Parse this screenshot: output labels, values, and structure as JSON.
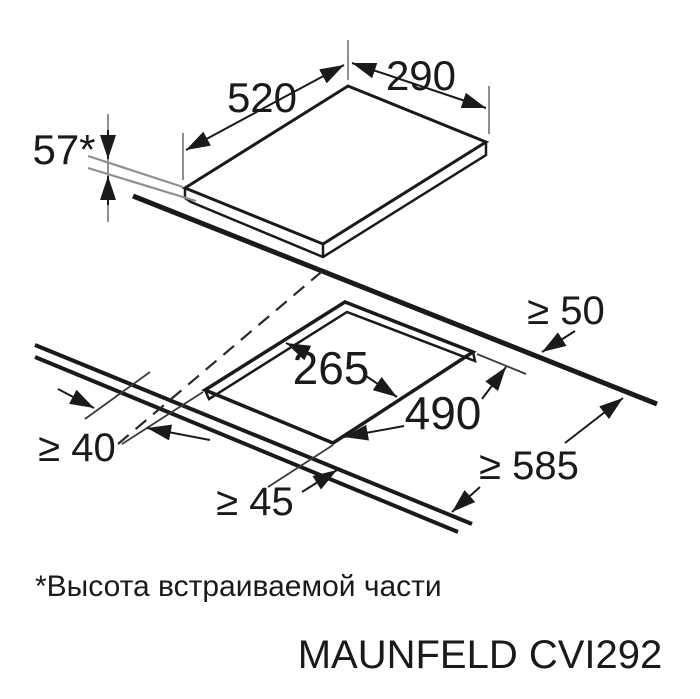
{
  "diagram": {
    "type": "installation-dimensions",
    "hob": {
      "depth_label": "520",
      "width_label": "290",
      "builtin_height_label": "57*"
    },
    "cutout": {
      "width_label": "265",
      "depth_label": "490"
    },
    "clearances": {
      "rear": "≥ 50",
      "side": "≥ 40",
      "front": "≥ 45",
      "counter_depth": "≥ 585"
    }
  },
  "footnote": "*Высота встраиваемой части",
  "model": "MAUNFELD CVI292",
  "colors": {
    "line": "#1a1a1a",
    "thin_gray": "#8f8f8f",
    "background": "#ffffff"
  }
}
